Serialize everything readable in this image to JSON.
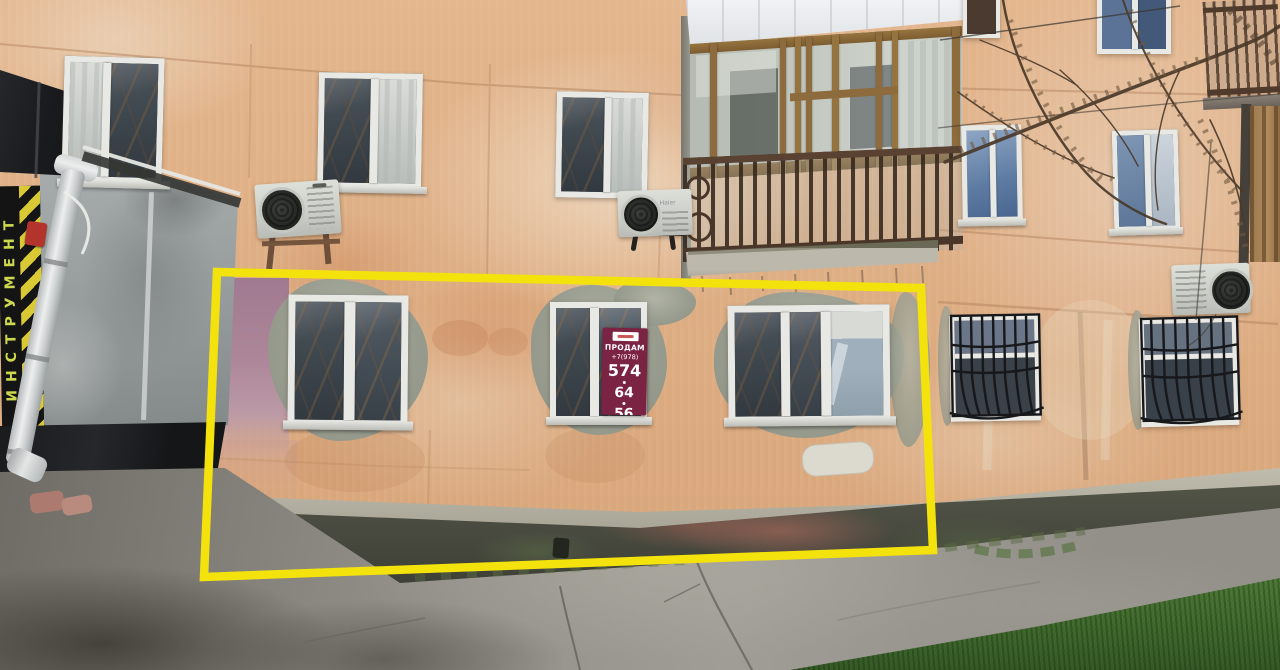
{
  "sale_sign": {
    "title": "ПРОДАМ",
    "phone_prefix": "+7(978)",
    "phone_part1": "574",
    "phone_part2": "64",
    "phone_part3": "56",
    "bg": "#7b2342",
    "fg": "#ffffff",
    "chip_color": "#ffffff"
  },
  "tool_sign": {
    "text": "ИНСТРУМЕНТ",
    "fg": "#cdd84e",
    "bg": "#141414",
    "stripe_yellow": "#d9ca35"
  },
  "ac": {
    "brand": "Haier"
  },
  "highlight": {
    "color": "#f3e20c",
    "points": "217,272 921,288 933,550 204,577",
    "stroke_width": "8.5"
  },
  "palette": {
    "wall": "#dcab80",
    "cement_patch": "#9a9e90",
    "plinth": "#4b4d42",
    "plinth_pink": "#8f5f55",
    "pavement": "#96948c",
    "grass": "#47702f",
    "annex_gray": "#9aa0a0",
    "signboard_black": "#17181a",
    "window_frame": "#e8e9e4",
    "balcony_wood": "#8d6b3c",
    "railing_rust": "#4a3628"
  }
}
